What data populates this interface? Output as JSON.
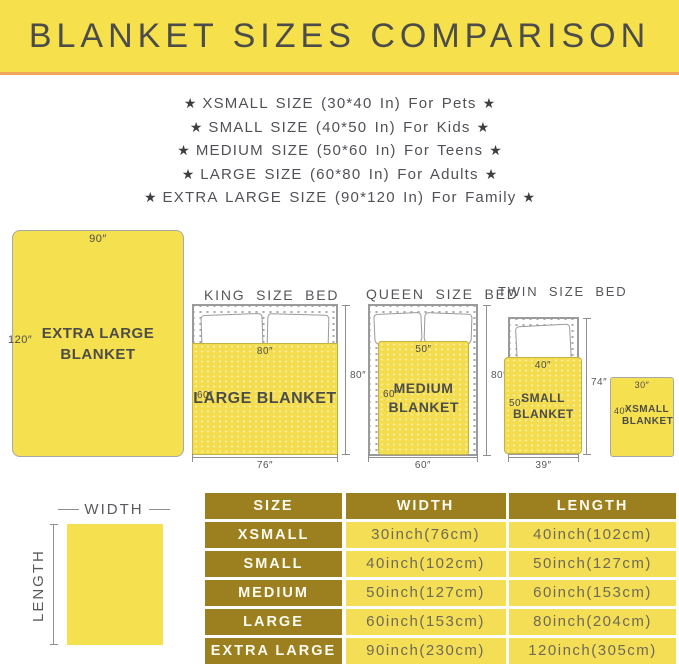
{
  "header": {
    "title": "BLANKET SIZES COMPARISON"
  },
  "star": "★",
  "size_list": [
    "XSMALL SIZE (30*40 In) For Pets",
    "SMALL SIZE (40*50 In) For Kids",
    "MEDIUM SIZE (50*60 In) For Teens",
    "LARGE SIZE (60*80 In) For Adults",
    "EXTRA LARGE SIZE (90*120 In) For Family"
  ],
  "diagram": {
    "extra_large": {
      "name": "EXTRA LARGE BLANKET",
      "top": "90″",
      "side": "120″"
    },
    "king": {
      "title": "KING SIZE BED",
      "blanket_name": "LARGE BLANKET",
      "blanket_width": "80″",
      "blanket_height": "60″",
      "bed_width": "76″",
      "bed_height": "80″"
    },
    "queen": {
      "title": "QUEEN SIZE BED",
      "blanket_name": "MEDIUM BLANKET",
      "blanket_width": "50″",
      "blanket_height": "60″",
      "bed_width": "60″",
      "bed_height": "80″"
    },
    "twin": {
      "title": "TWIN SIZE BED",
      "blanket_name": "SMALL BLANKET",
      "blanket_width": "40″",
      "blanket_height": "50″",
      "bed_width": "39″",
      "bed_height": "74″"
    },
    "xsmall": {
      "name": "XSMALL BLANKET",
      "top": "30″",
      "side": "40″"
    },
    "legend": {
      "width_label": "WIDTH",
      "length_label": "LENGTH"
    }
  },
  "table": {
    "headers": [
      "SIZE",
      "WIDTH",
      "LENGTH"
    ],
    "rows": [
      [
        "XSMALL",
        "30inch(76cm)",
        "40inch(102cm)"
      ],
      [
        "SMALL",
        "40inch(102cm)",
        "50inch(127cm)"
      ],
      [
        "MEDIUM",
        "50inch(127cm)",
        "60inch(153cm)"
      ],
      [
        "LARGE",
        "60inch(153cm)",
        "80inch(204cm)"
      ],
      [
        "EXTRA LARGE",
        "90inch(230cm)",
        "120inch(305cm)"
      ]
    ]
  },
  "colors": {
    "banner_yellow": "#F6E04B",
    "divider_orange": "#F0A45C",
    "blanket_yellow": "#F3DD4F",
    "card_yellow": "#F5E050",
    "table_gold": "#9C7F1E",
    "table_yellow": "#F4DE55",
    "title_ink": "#4C4C4A",
    "body_ink": "#55565A",
    "table_text": "#6E6A55"
  }
}
